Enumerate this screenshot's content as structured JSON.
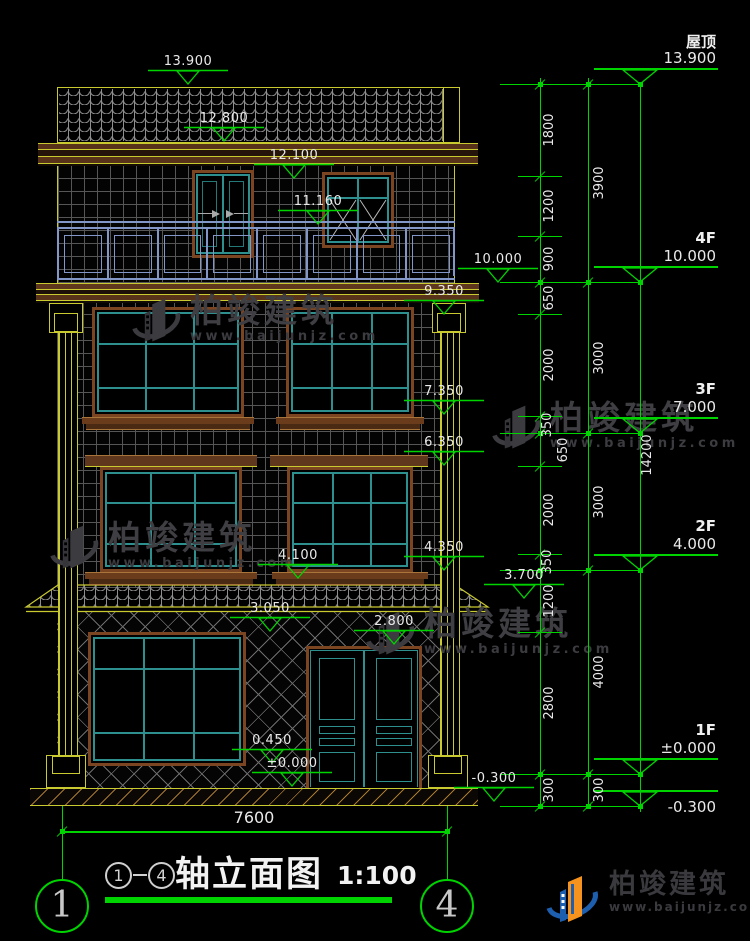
{
  "drawing_title": {
    "axis_from": "1",
    "axis_to": "4",
    "separator": "-",
    "name": "轴立面图",
    "scale": "1:100"
  },
  "axis_bubbles": [
    "1",
    "4"
  ],
  "levels": [
    {
      "name": "屋顶",
      "value": "13.900"
    },
    {
      "name": "4F",
      "value": "10.000"
    },
    {
      "name": "3F",
      "value": "7.000"
    },
    {
      "name": "2F",
      "value": "4.000"
    },
    {
      "name": "1F",
      "value": "±0.000"
    },
    {
      "name": "",
      "value": "-0.300"
    }
  ],
  "overall_height": "14200",
  "overall_width": "7600",
  "dims_inner": [
    "1800",
    "1200",
    "900",
    "650",
    "2000",
    "350",
    "650",
    "2000",
    "350",
    "1200",
    "2800",
    "300"
  ],
  "dims_outer": [
    "3900",
    "3000",
    "3000",
    "4000",
    "300"
  ],
  "spot_elevations": [
    "13.900",
    "12.800",
    "12.100",
    "11.160",
    "10.000",
    "9.350",
    "7.350",
    "6.350",
    "4.350",
    "4.100",
    "3.700",
    "3.050",
    "2.800",
    "0.450",
    "±0.000",
    "-0.300"
  ],
  "watermark": {
    "brand": "柏竣建筑",
    "site": "www.baijunjz.com"
  },
  "logo": {
    "brand": "柏竣建筑",
    "site": "www.baijunjz.com"
  },
  "colors": {
    "dim_green": "#00d400",
    "line_yellow": "#c9c930",
    "frame_brown": "#7a4520",
    "window_teal": "#2e8f8f",
    "railing_blue": "#8296c8",
    "text_white": "#e9e9e9"
  }
}
